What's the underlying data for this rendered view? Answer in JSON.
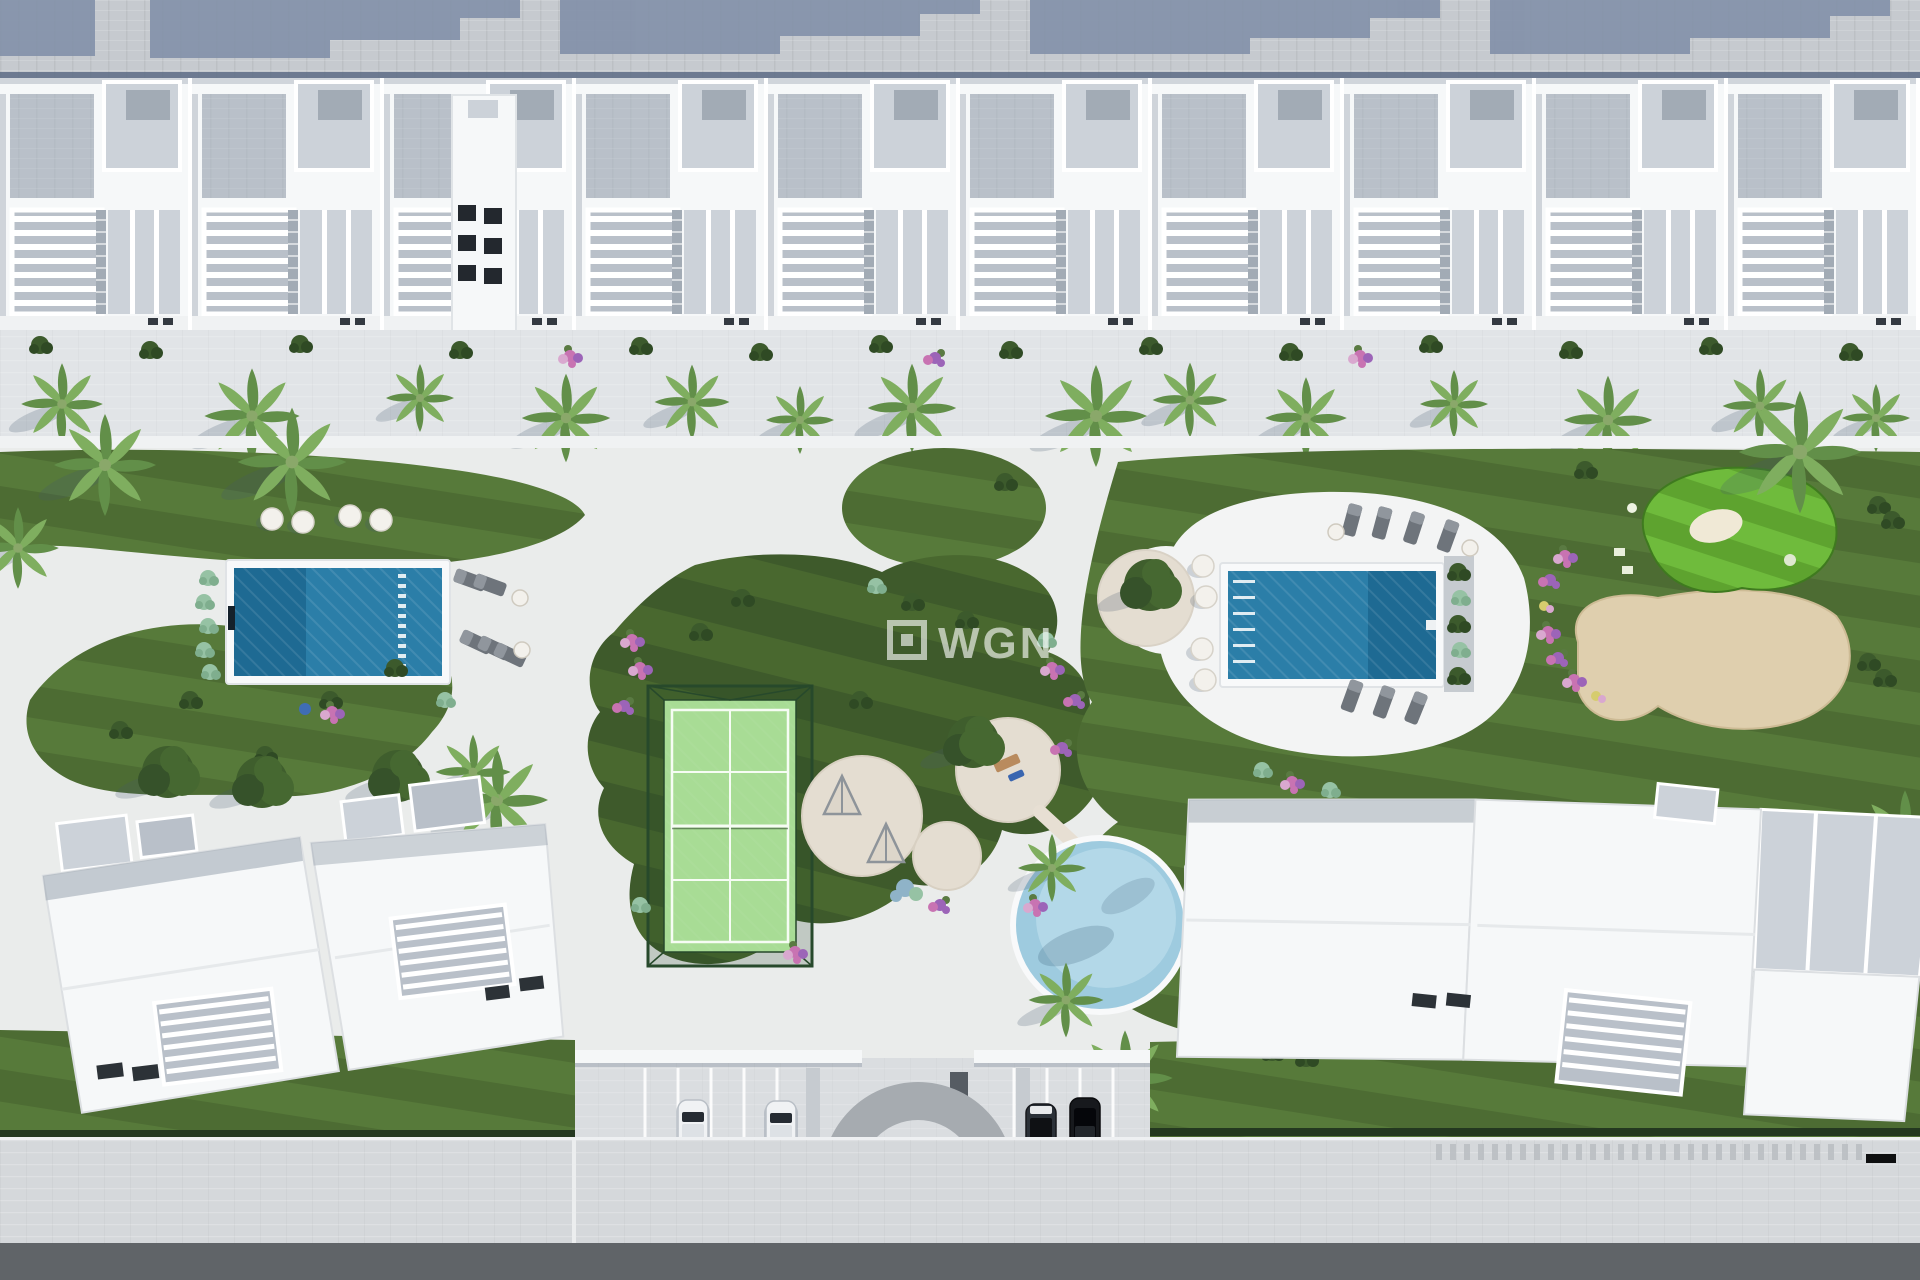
{
  "watermark": {
    "brand": "WGN",
    "icon": "square-logo-icon",
    "color": "rgba(255,255,255,0.62)"
  },
  "palette": {
    "plaza": "#eaeceb",
    "plaza_bright": "#f3f4f4",
    "top_road": "#c6cacf",
    "road_shadow": "#8290a9",
    "fence": "#5d6c86",
    "house_white": "#f6f8f9",
    "roof_deck": "#b9c0c9",
    "roof_deck_dark": "#a2abb5",
    "penthouse_gray": "#ccd2d9",
    "terrace_band": "#e1e4e7",
    "walk_white": "#f0f2f3",
    "lawn_a": "#4d6c33",
    "lawn_b": "#577a3a",
    "lawn_dark_a": "#3e5a2b",
    "lawn_dark_b": "#49682f",
    "golf_a": "#5ea32f",
    "golf_b": "#6fbb3c",
    "bunker": "#f0e9d6",
    "sand": "#dfcfae",
    "sand_edge": "#cdbb95",
    "court_green": "#a8dc95",
    "court_line": "#f6fcf4",
    "cage": "#27492b",
    "cage_fill": "rgba(30,66,36,0.20)",
    "pool_main": "#2b7ea8",
    "pool_deep": "#1e6a93",
    "pool_rim": "#f8f9fa",
    "water_steps": "rgba(255,255,255,0.85)",
    "kids_pool": "#9ecbdf",
    "kids_pool_light": "#b3d8e8",
    "paver": "#e4ddd1",
    "pouf": "#f3f1ec",
    "lounger": "#6e747b",
    "lounger_light": "#90969d",
    "bush_a": "#3c5a2c",
    "bush_b": "#2f4a24",
    "mint_a": "#96c2a4",
    "mint_b": "#7fae8e",
    "blue_bush": "#8fb3c8",
    "flower_pink": "#c873b2",
    "flower_pink2": "#d9a8cf",
    "flower_violet": "#9c64b8",
    "flower_yellow": "#d6cc6e",
    "palm_a": "#628f49",
    "palm_b": "#7fae5f",
    "tree_a": "#3f5e2d",
    "tree_b": "#466831",
    "tree_c": "#36522a",
    "shadow": "rgba(70,85,110,0.22)",
    "shadow_strong": "rgba(60,75,100,0.35)",
    "wall_white": "#f5f7f8",
    "arch": "#a6abb0",
    "pillar": "#c6cbd0",
    "sidewalk": "#d5d8db",
    "sidewalk_tick": "#b9bdc2",
    "road_dark": "#606468",
    "curb": "#eef0f2",
    "hedge": "#243820",
    "car_white": "#f0f2f4",
    "car_glass": "#262c33",
    "car_roof": "#dde1e5",
    "car_dark": "#2b3138",
    "car_black": "#17191d"
  },
  "scene": {
    "top_row_house_count": 10,
    "terrace_palms": [
      [
        62,
        404,
        1.2
      ],
      [
        252,
        416,
        1.4
      ],
      [
        420,
        398,
        1.0
      ],
      [
        566,
        418,
        1.3
      ],
      [
        692,
        402,
        1.1
      ],
      [
        800,
        420,
        1.0
      ],
      [
        912,
        408,
        1.3
      ],
      [
        1096,
        416,
        1.5
      ],
      [
        1190,
        400,
        1.1
      ],
      [
        1306,
        418,
        1.2
      ],
      [
        1454,
        404,
        1.0
      ],
      [
        1608,
        420,
        1.3
      ],
      [
        1760,
        406,
        1.1
      ],
      [
        1876,
        418,
        1.0
      ]
    ],
    "garden_palms": [
      [
        105,
        465,
        1.5
      ],
      [
        292,
        462,
        1.6
      ],
      [
        18,
        548,
        1.2
      ],
      [
        497,
        800,
        1.5
      ],
      [
        473,
        772,
        1.1
      ],
      [
        1800,
        452,
        1.8
      ],
      [
        1905,
        838,
        1.4
      ],
      [
        1125,
        1078,
        1.4
      ],
      [
        1052,
        868,
        1.0
      ],
      [
        1066,
        1000,
        1.1
      ]
    ],
    "garden_poufs": [
      [
        272,
        519
      ],
      [
        303,
        522
      ],
      [
        350,
        516
      ],
      [
        381,
        520
      ]
    ],
    "right_deck_poufs": [
      [
        1203,
        566
      ],
      [
        1206,
        597
      ],
      [
        1202,
        649
      ],
      [
        1205,
        680
      ]
    ],
    "left_pool_loungers": [
      [
        470,
        580,
        -70
      ],
      [
        490,
        585,
        -70
      ],
      [
        476,
        642,
        -65
      ],
      [
        494,
        648,
        -65
      ],
      [
        510,
        655,
        -65
      ]
    ],
    "right_pool_loungers": [
      [
        1352,
        520,
        15
      ],
      [
        1382,
        523,
        15
      ],
      [
        1414,
        528,
        18
      ],
      [
        1448,
        536,
        20
      ],
      [
        1352,
        696,
        20
      ],
      [
        1384,
        702,
        20
      ],
      [
        1416,
        708,
        22
      ]
    ],
    "tables": [
      [
        520,
        598
      ],
      [
        522,
        650
      ],
      [
        1336,
        532
      ],
      [
        1470,
        548
      ]
    ],
    "cars": [
      {
        "x": 678,
        "y": 1100,
        "variant": "white"
      },
      {
        "x": 766,
        "y": 1101,
        "variant": "white"
      },
      {
        "x": 1026,
        "y": 1104,
        "variant": "dark"
      },
      {
        "x": 1070,
        "y": 1098,
        "variant": "black"
      }
    ]
  }
}
